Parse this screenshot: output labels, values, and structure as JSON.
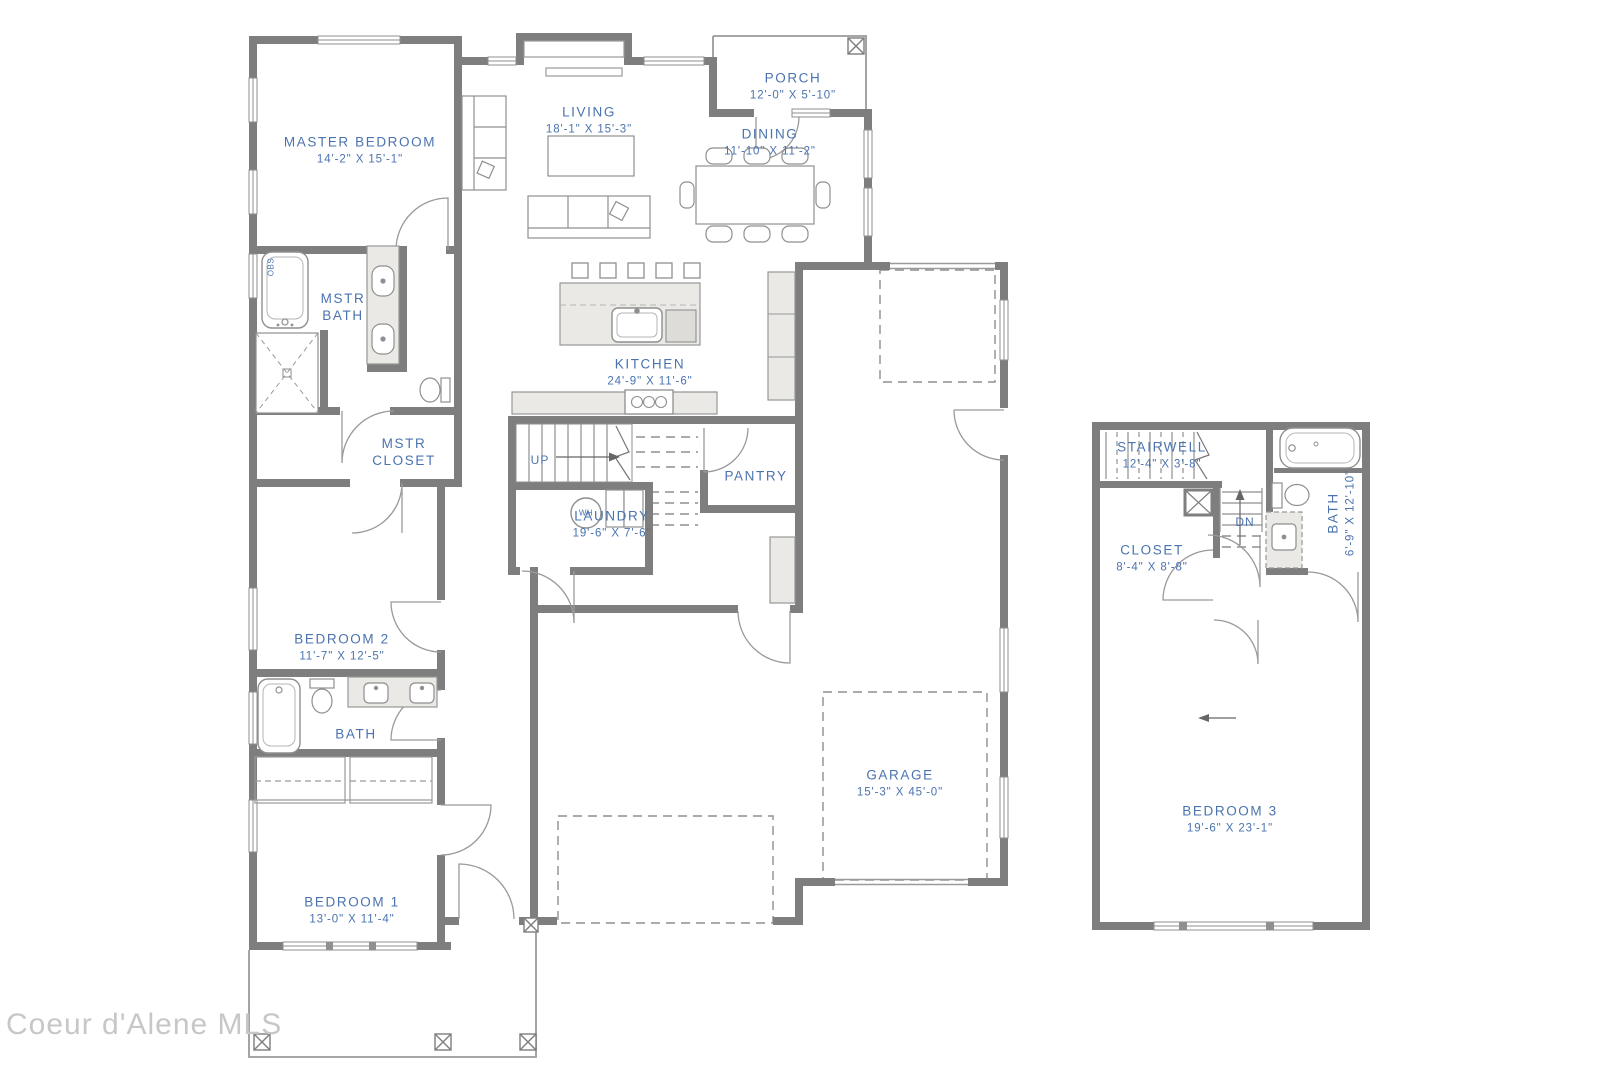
{
  "watermark": "Coeur d'Alene MLS",
  "colors": {
    "label_blue": "#4a73af",
    "wall_gray": "#7e7e7e",
    "fixture_fill": "#eae9e5",
    "watermark_gray": "#c7c7c7"
  },
  "main_floor": {
    "rooms": {
      "master_bedroom": {
        "name": "MASTER BEDROOM",
        "dims": "14'-2\" X 15'-1\""
      },
      "living": {
        "name": "LIVING",
        "dims": "18'-1\" X 15'-3\""
      },
      "porch": {
        "name": "PORCH",
        "dims": "12'-0\" X 5'-10\""
      },
      "dining": {
        "name": "DINING",
        "dims": "11'-10\" X 11'-2\""
      },
      "mstr_bath": {
        "name": "MSTR BATH"
      },
      "mstr_closet": {
        "name": "MSTR CLOSET"
      },
      "kitchen": {
        "name": "KITCHEN",
        "dims": "24'-9\" X 11'-6\""
      },
      "pantry": {
        "name": "PANTRY"
      },
      "laundry": {
        "name": "LAUNDRY",
        "dims": "19'-6\" X 7'-6\""
      },
      "bedroom_2": {
        "name": "BEDROOM 2",
        "dims": "11'-7\" X 12'-5\""
      },
      "bath": {
        "name": "BATH"
      },
      "bedroom_1": {
        "name": "BEDROOM 1",
        "dims": "13'-0\" X 11'-4\""
      },
      "garage": {
        "name": "GARAGE",
        "dims": "15'-3\" X 45'-0\""
      }
    },
    "annotations": {
      "up": "UP",
      "wh": "WH",
      "obs": "OBS"
    }
  },
  "upper_floor": {
    "rooms": {
      "stairwell": {
        "name": "STAIRWELL",
        "dims": "12'-4\" X 3'-8\""
      },
      "closet": {
        "name": "CLOSET",
        "dims": "8'-4\" X 8'-8\""
      },
      "bath": {
        "name": "BATH",
        "dims": "6'-9\" X 12'-10\""
      },
      "bedroom_3": {
        "name": "BEDROOM 3",
        "dims": "19'-6\" X 23'-1\""
      }
    },
    "annotations": {
      "dn": "DN"
    }
  }
}
